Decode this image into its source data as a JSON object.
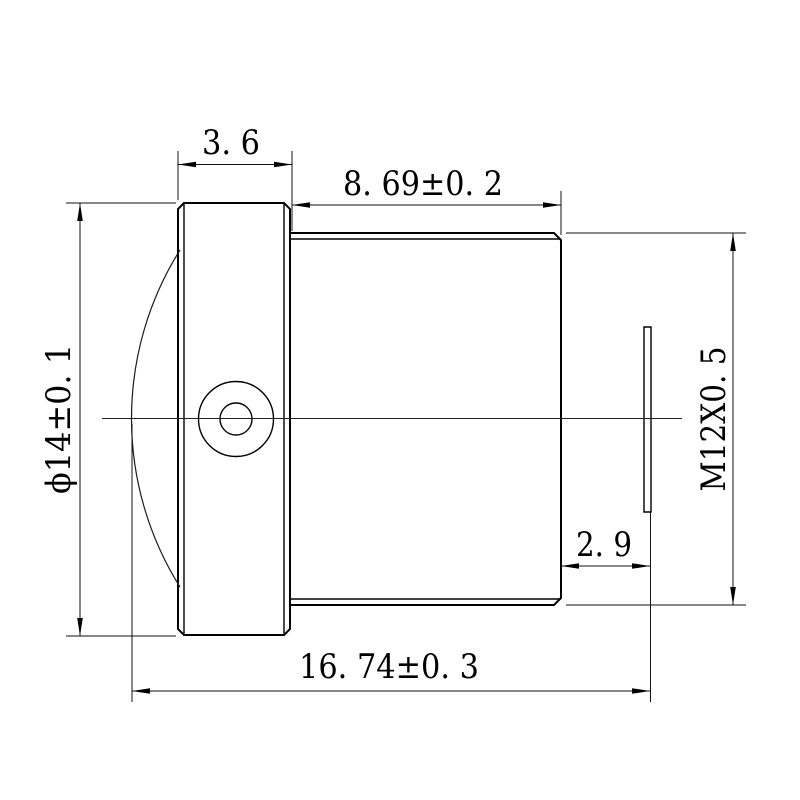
{
  "page": {
    "background_color": "#ffffff",
    "line_color": "#000000"
  },
  "dimensions": {
    "front_cap_width": "3. 6",
    "barrel_length": "8. 69±0. 2",
    "front_diameter": "ϕ14±0. 1",
    "thread_spec": "M12X0. 5",
    "rear_offset": "2. 9",
    "overall_length": "16. 74±0. 3"
  }
}
